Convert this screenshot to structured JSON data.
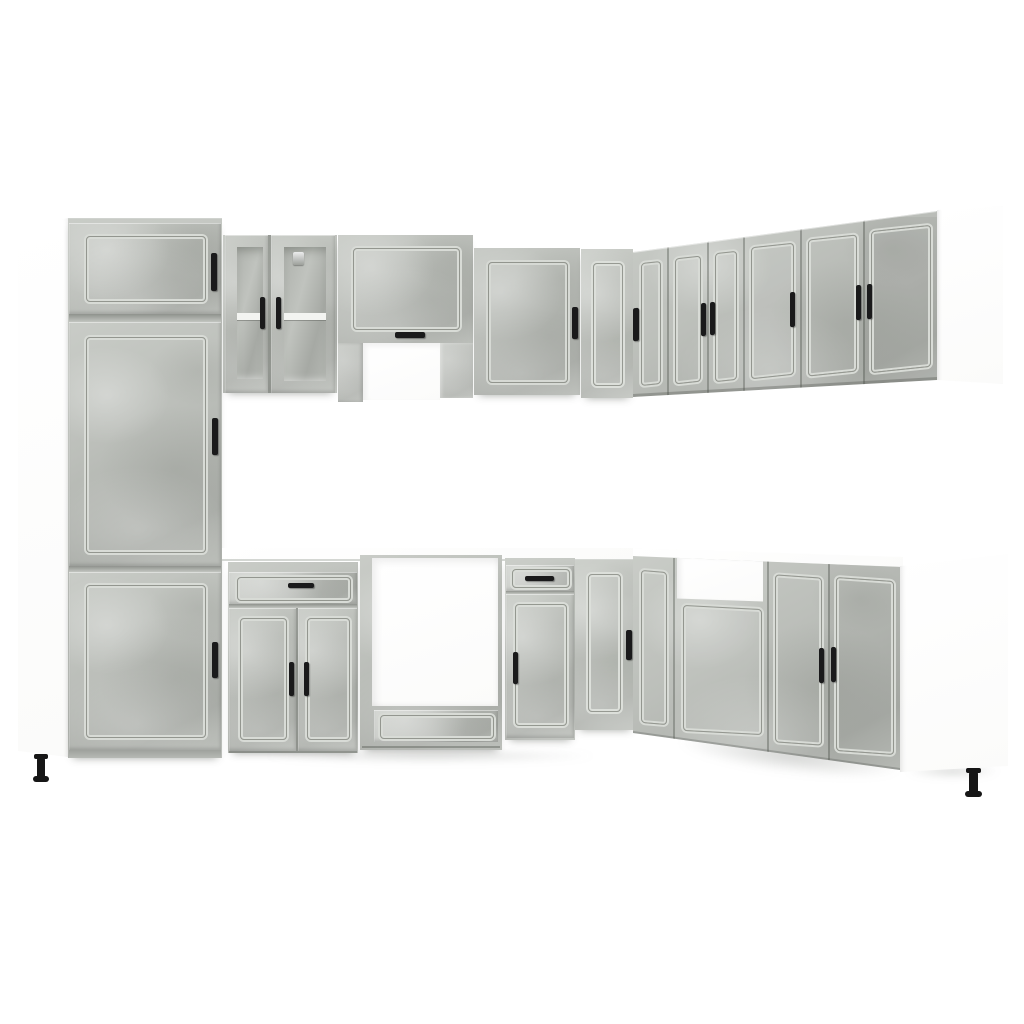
{
  "image_type": "product-photo",
  "subject": "l-shaped-kitchen-cabinet-set",
  "colors": {
    "background": "#ffffff",
    "cab": "#bcbfba",
    "cab_l": "#c9ccc7",
    "cab_d": "#aaada8",
    "groove_l": "#d8dbd6",
    "groove_d": "#93968f",
    "handle": "#1a1a1b",
    "glass_a": "#aeb1ac",
    "glass_b": "#c0c3be",
    "shelf": "#f3f4f1",
    "carcass": "#ffffff",
    "counter_line": "#d4d7d3",
    "leg": "#161616"
  },
  "scene": {
    "finish": "concrete-gray fronts, white carcass, black bar handles, black adjustable feet",
    "left_wall_units": [
      {
        "name": "tall-pantry-cabinet",
        "doors": 3,
        "handles": 3
      },
      {
        "name": "glass-wall-cabinet",
        "doors": 2,
        "handles": 2,
        "shelf": 1
      },
      {
        "name": "hood-bridge-cabinet",
        "doors": 1,
        "handles": 1,
        "open_recess": true
      },
      {
        "name": "wall-cabinet-single",
        "doors": 1,
        "handles": 1
      },
      {
        "name": "corner-wall-cabinet",
        "doors": 1,
        "handles": 1
      }
    ],
    "right_wall_units": [
      {
        "name": "wall-cabinet-double",
        "doors": 2,
        "handles": 2
      },
      {
        "name": "wall-cabinet-single",
        "doors": 1,
        "handles": 1
      },
      {
        "name": "wall-cabinet-double-2",
        "doors": 2,
        "handles": 2
      },
      {
        "name": "end-panel-white",
        "doors": 0,
        "handles": 0
      }
    ],
    "base_units": [
      {
        "name": "drawer-base-cabinet",
        "doors": 2,
        "drawers": 1,
        "handles": 3
      },
      {
        "name": "oven-housing-cabinet",
        "open_cavity": true,
        "drawers": 1
      },
      {
        "name": "drawer-door-base-cabinet",
        "doors": 1,
        "drawers": 1,
        "handles": 2
      },
      {
        "name": "corner-base-cabinet",
        "doors": 1,
        "handles": 1
      },
      {
        "name": "sink-base-cabinet",
        "open_top_recess": true,
        "doors": 1
      },
      {
        "name": "base-cabinet-double",
        "doors": 2,
        "handles": 2
      },
      {
        "name": "end-panel-white-base",
        "doors": 0,
        "handles": 0
      }
    ]
  }
}
